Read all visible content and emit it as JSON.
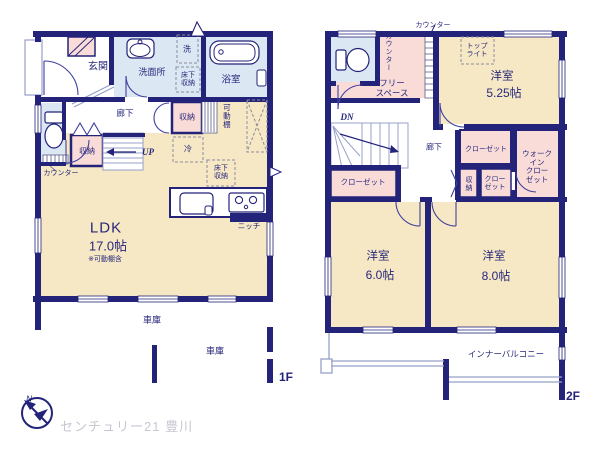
{
  "brand": {
    "logo_text": "センチュリー21 豊川",
    "compass_north": "N"
  },
  "floor1": {
    "floor_tag": "1F",
    "labels": {
      "genkan": "玄関",
      "washroom": "洗面所",
      "laundry": "洗",
      "underfloor_storage_wash": [
        "床下",
        "収納"
      ],
      "bath": "浴室",
      "hallway": "廊下",
      "toilet_counter": "カウンター",
      "storage_hall": "収納",
      "storage_dining": "収納",
      "movable_shelf": "可動棚",
      "stairs_up": "UP",
      "fridge": "冷",
      "underfloor_storage_kitchen": [
        "床下",
        "収納"
      ],
      "niche": "ニッチ",
      "ldk_name": "LDK",
      "ldk_size": "17.0帖",
      "ldk_note": "※可動棚含",
      "garage_rear": "車庫",
      "garage_front": "車庫"
    }
  },
  "floor2": {
    "floor_tag": "2F",
    "labels": {
      "counter_top": "カウンター",
      "counter_side": "カウンター",
      "free_space": [
        "フリー",
        "スペース"
      ],
      "skylight": [
        "トップ",
        "ライト"
      ],
      "bedroom_525_name": "洋室",
      "bedroom_525_size": "5.25帖",
      "stairs_down": "DN",
      "hallway": "廊下",
      "closet_upper": "クローゼット",
      "walk_in_closet": [
        "ウォーク",
        "イン",
        "クロー",
        "ゼット"
      ],
      "closet_left": "クローゼット",
      "storage": "収納",
      "closet_small": [
        "クロー",
        "ゼット"
      ],
      "bedroom_60_name": "洋室",
      "bedroom_60_size": "6.0帖",
      "bedroom_80_name": "洋室",
      "bedroom_80_size": "8.0帖",
      "inner_balcony": "インナーバルコニー"
    }
  }
}
